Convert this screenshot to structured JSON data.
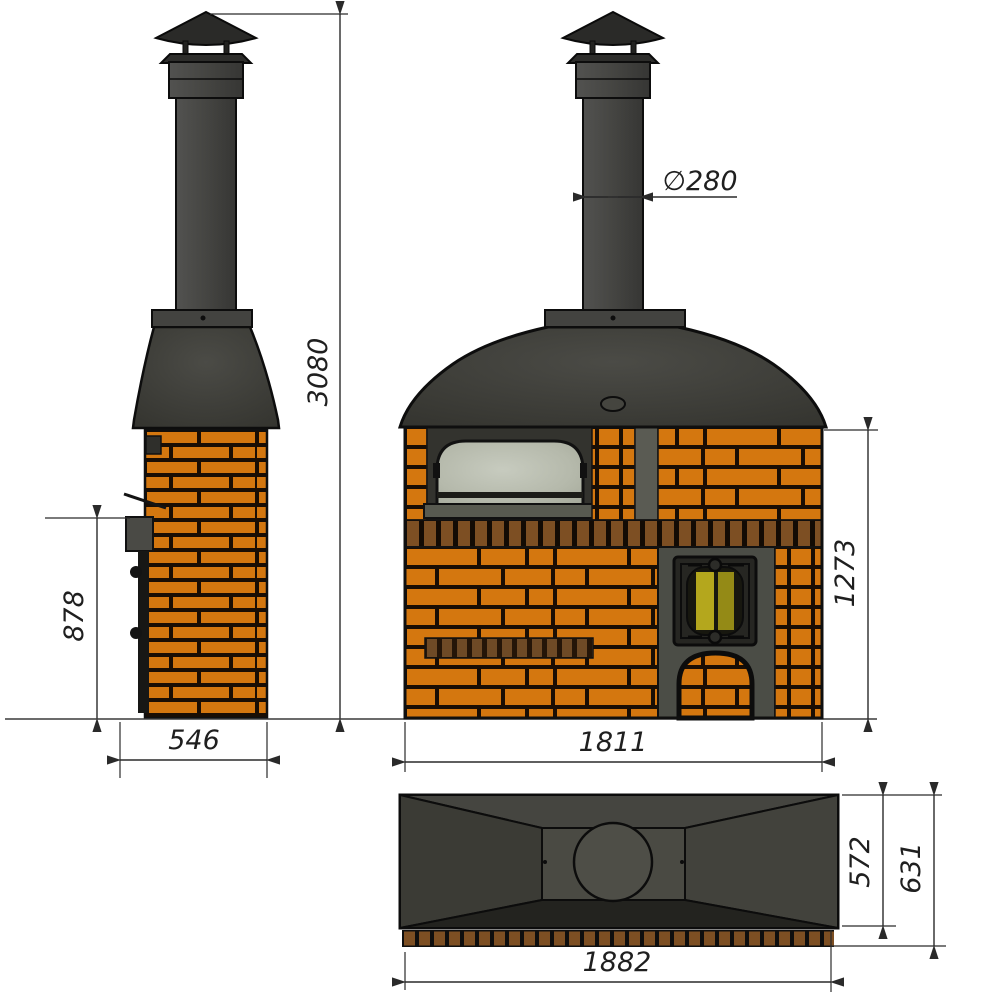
{
  "drawing": {
    "description": "Three-view technical drawing of a brick wood-fired barbecue oven with steel smoke hood and chimney",
    "background": "#ffffff",
    "dimension_line_color": "#2a2a2a",
    "brick_color": "#d4770f",
    "mortar_color": "#1a0e04",
    "soldier_brick_color": "#7d4f23",
    "metal_dark_color": "#3f3f3b",
    "oven_glass_color": "#b9bdb1",
    "fire_door_glass_color": "#b4a71d"
  },
  "side_view": {
    "total_height": "3080",
    "firebox_section_height": "878",
    "depth": "546"
  },
  "front_view": {
    "chimney_diameter": "∅280",
    "masonry_height": "1273",
    "width": "1811"
  },
  "top_view": {
    "hood_depth": "572",
    "overall_depth": "631",
    "overall_width": "1882"
  }
}
